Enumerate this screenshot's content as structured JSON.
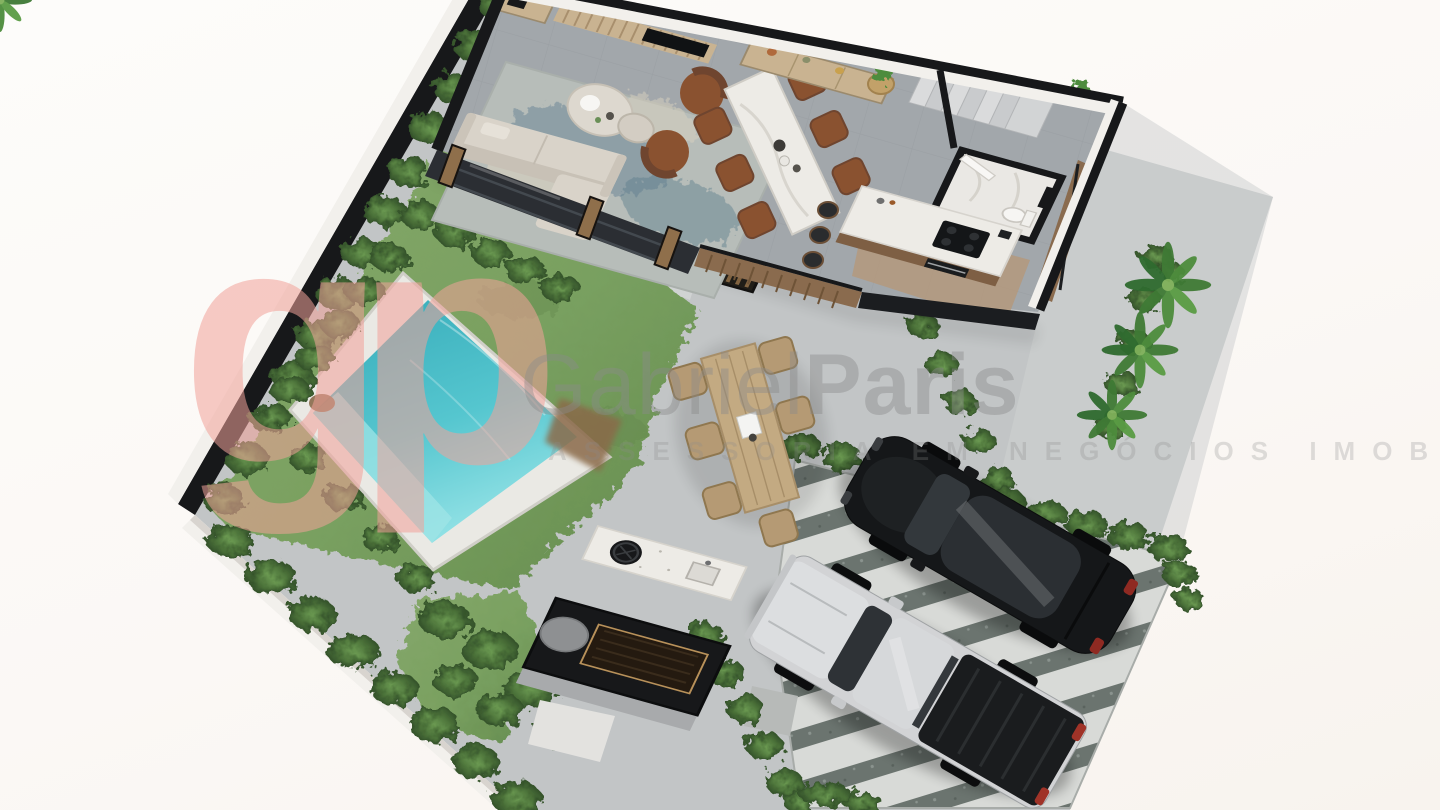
{
  "meta": {
    "kind": "3d-floor-plan-render",
    "width": 1440,
    "height": 810
  },
  "watermark": {
    "logo_text": "gp",
    "brand_primary": "Gabriel",
    "brand_secondary": "Paris",
    "tagline": "ASSESSORIA EM NEGÓCIOS IMOBILIÁRIOS"
  },
  "palette": {
    "concrete": "#c6c9ca",
    "paver_light": "#d8dad7",
    "paver_dark": "#6b746f",
    "grass_light": "#8aab6e",
    "grass_dark": "#5f8549",
    "hedge": "#46693a",
    "hedge_light": "#6b9a52",
    "pool_water": "#3fb6c2",
    "pool_water_light": "#8fe0e4",
    "pool_deck": "#eae9e4",
    "wall_black": "#17181a",
    "wall_white": "#f2f0ec",
    "floor_tile": "#a2a7ab",
    "wood": "#c9b391",
    "wood_dark": "#8a6b4e",
    "marble": "#edebe6",
    "sofa": "#d9d3c9",
    "leather": "#8a5230",
    "car_black": "#151719",
    "car_silver": "#d2d3d5",
    "watermark_pink": "#f2a29a",
    "watermark_gray": "#8b8b8b"
  }
}
